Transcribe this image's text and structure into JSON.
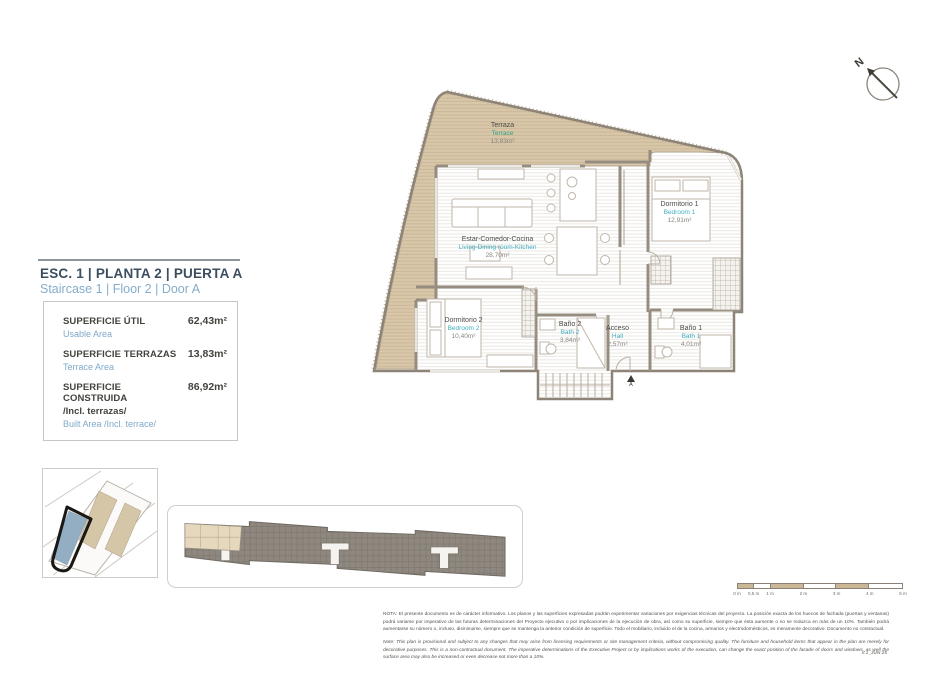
{
  "plan": {
    "title": "ESC. 1 | PLANTA 2 | PUERTA A",
    "subtitle": "Staircase 1 | Floor 2 | Door A"
  },
  "areas": [
    {
      "label": "SUPERFICIE ÚTIL",
      "sublabel": "Usable Area",
      "value": "62,43m²"
    },
    {
      "label": "SUPERFICIE TERRAZAS",
      "sublabel": "Terrace Area",
      "value": "13,83m²"
    },
    {
      "label": "SUPERFICIE CONSTRUIDA",
      "label2": "/Incl. terrazas/",
      "sublabel": "Built Area /Incl. terrace/",
      "value": "86,92m²"
    }
  ],
  "rooms": [
    {
      "name_es": "Terraza",
      "name_en": "Terrace",
      "area": "13,83m²"
    },
    {
      "name_es": "Estar-Comedor-Cocina",
      "name_en": "Living-Dining room-Kitchen",
      "area": "28,70m²"
    },
    {
      "name_es": "Dormitorio 1",
      "name_en": "Bedroom 1",
      "area": "12,91m²"
    },
    {
      "name_es": "Dormitorio 2",
      "name_en": "Bedroom 2",
      "area": "10,40m²"
    },
    {
      "name_es": "Baño 2",
      "name_en": "Bath 2",
      "area": "3,84m²"
    },
    {
      "name_es": "Acceso",
      "name_en": "Hall",
      "area": "2,57m²"
    },
    {
      "name_es": "Baño 1",
      "name_en": "Bath 1",
      "area": "4,01m²"
    }
  ],
  "entry": {
    "door_label": "A"
  },
  "compass": {
    "north_label": "N"
  },
  "scale_bar": {
    "unit_labels": [
      "0 m",
      "0,5 m",
      "1 m",
      "2 m",
      "3 m",
      "4 m",
      "5 m"
    ]
  },
  "notes": {
    "spanish": "NOTA: El presente documento es de carácter informativo. Los planos y las superficies expresadas podrán experimentar variaciones por exigencias técnicas del proyecto. La posición exacta de los huecos de fachada (puertas y ventanas) podrá variarse por imperativo de las futuras determinaciones del Proyecto ejecutivo o por implicaciones de la ejecución de obra, así como su superficie, siempre que ésta aumente o no se reduzca en más de un 10%. También podrá aumentarse su número o, incluso, disminuirse, siempre que se mantenga la anterior condición de superficie. Todo el mobiliario, incluido el de la cocina, armarios y electrodomésticos, es meramente decorativo. Documento no contractual.",
    "english": "Note: This plan is provisional and subject to any changes that may arise from licensing requirements or site management criteria, without compromising quality. The furniture and household items that appear in the plan are merely for decorative purposes. This is a non-contractual document. The imperative determinations of the Executive Project or by implications works of the execution, can change the exact position of the facade of doors and windows, as well the surface area may also be increased or even decrease not more than a 10%.",
    "version": "V.1_JUN 25"
  },
  "colors": {
    "terrace_fill": "#d8c7aa",
    "wall": "#968d80",
    "accent_teal": "#3fafc0",
    "accent_green": "#2fa285",
    "accent_blue": "#84adca",
    "title_navy": "#3c4d60",
    "highlight_building": "#93aec3"
  }
}
